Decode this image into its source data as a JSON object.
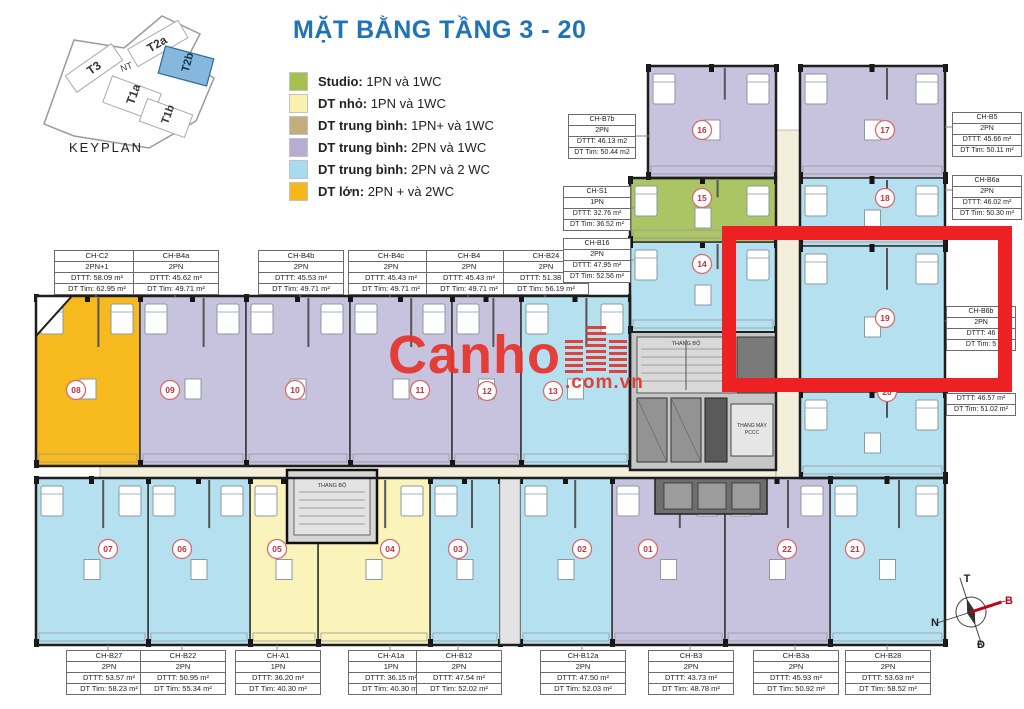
{
  "title": "MẶT BẰNG TẦNG 3 - 20",
  "keyplan": {
    "caption": "KEYPLAN",
    "buildings": [
      {
        "name": "T3"
      },
      {
        "name": "NT"
      },
      {
        "name": "T2a"
      },
      {
        "name": "T2b",
        "highlighted": true
      },
      {
        "name": "T1a"
      },
      {
        "name": "T1b"
      }
    ]
  },
  "legend": [
    {
      "color": "#a4c04e",
      "bold": "Studio:",
      "rest": " 1PN và 1WC"
    },
    {
      "color": "#f8f2ad",
      "bold": "DT nhỏ:",
      "rest": " 1PN  và 1WC"
    },
    {
      "color": "#c4ad7c",
      "bold": "DT trung bình:",
      "rest": " 1PN+ và 1WC"
    },
    {
      "color": "#b6add5",
      "bold": "DT trung bình:",
      "rest": " 2PN và 1WC"
    },
    {
      "color": "#a8dbed",
      "bold": "DT trung bình:",
      "rest": " 2PN và 2 WC"
    },
    {
      "color": "#f6b71b",
      "bold": "DT lớn:",
      "rest": " 2PN + và 2WC"
    }
  ],
  "watermark": {
    "word": "Canho",
    "suffix": ".com.vn"
  },
  "compass": {
    "top": "T",
    "right": "B",
    "left": "N",
    "bottom": "Đ"
  },
  "core_labels": {
    "stair1": "THANG BỘ",
    "stair2": "THANG BỘ",
    "fire1": "THANG MÁY",
    "fire2": "PCCC"
  },
  "colors": {
    "title_blue": "#2173b4",
    "annotation_red": "#ed2024",
    "watermark_red": "#e63329",
    "number_red": "#c23340",
    "corridor": "#f3eeda",
    "core_gray": "#c6c6c6",
    "unit_fills": {
      "green": "#abc464",
      "yellow": "#faf4bb",
      "lav": "#c7c2de",
      "blue": "#b4e0ef",
      "orange": "#f7ba1e"
    }
  },
  "units": [
    {
      "no": "01",
      "fill": "lav"
    },
    {
      "no": "02",
      "fill": "blue"
    },
    {
      "no": "03",
      "fill": "blue"
    },
    {
      "no": "04",
      "fill": "yellow"
    },
    {
      "no": "05",
      "fill": "yellow"
    },
    {
      "no": "06",
      "fill": "blue"
    },
    {
      "no": "07",
      "fill": "blue"
    },
    {
      "no": "08",
      "fill": "orange"
    },
    {
      "no": "09",
      "fill": "lav"
    },
    {
      "no": "10",
      "fill": "lav"
    },
    {
      "no": "11",
      "fill": "lav"
    },
    {
      "no": "12",
      "fill": "lav"
    },
    {
      "no": "13",
      "fill": "blue"
    },
    {
      "no": "14",
      "fill": "blue"
    },
    {
      "no": "15",
      "fill": "green"
    },
    {
      "no": "16",
      "fill": "lav"
    },
    {
      "no": "17",
      "fill": "lav"
    },
    {
      "no": "18",
      "fill": "blue"
    },
    {
      "no": "19",
      "fill": "blue"
    },
    {
      "no": "20",
      "fill": "blue"
    },
    {
      "no": "21",
      "fill": "blue"
    },
    {
      "no": "22",
      "fill": "lav"
    }
  ],
  "unit_labels": [
    {
      "name": "CH-C2",
      "type": "2PN+1",
      "dtt": "DTTT: 58.09 m²",
      "dttim": "DT Tim: 62.95 m²"
    },
    {
      "name": "CH-B4a",
      "type": "2PN",
      "dtt": "DTTT: 45.62 m²",
      "dttim": "DT Tim: 49.71 m²"
    },
    {
      "name": "CH-B4b",
      "type": "2PN",
      "dtt": "DTTT: 45.53 m²",
      "dttim": "DT Tim: 49.71 m²"
    },
    {
      "name": "CH-B4c",
      "type": "2PN",
      "dtt": "DTTT: 45.43 m²",
      "dttim": "DT Tim: 49.71 m²"
    },
    {
      "name": "CH-B4",
      "type": "2PN",
      "dtt": "DTTT: 45.43 m²",
      "dttim": "DT Tim: 49.71 m²"
    },
    {
      "name": "CH-B24",
      "type": "2PN",
      "dtt": "DTTT: 51.38 m²",
      "dttim": "DT Tim: 56.19 m²"
    },
    {
      "name": "CH-B7b",
      "type": "2PN",
      "dtt": "DTTT: 46.13 m2",
      "dttim": "DT Tim: 50.44 m2"
    },
    {
      "name": "CH-S1",
      "type": "1PN",
      "dtt": "DTTT: 32.76 m²",
      "dttim": "DT Tim: 36.52 m²"
    },
    {
      "name": "CH-B16",
      "type": "2PN",
      "dtt": "DTTT: 47.95 m²",
      "dttim": "DT Tim: 52.56 m²"
    },
    {
      "name": "CH-B5",
      "type": "2PN",
      "dtt": "DTTT: 45.66 m²",
      "dttim": "DT Tim: 50.11 m²"
    },
    {
      "name": "CH-B6a",
      "type": "2PN",
      "dtt": "DTTT: 46.02 m²",
      "dttim": "DT Tim: 50.30 m²"
    },
    {
      "name": "CH-B6b",
      "type": "2PN",
      "dtt": "DTTT: 46",
      "dttim": "DT Tim: 5"
    },
    {
      "name": "",
      "type": "",
      "dtt": "DTTT: 46.57 m²",
      "dttim": "DT Tim: 51.02 m²"
    },
    {
      "name": "CH-B27",
      "type": "2PN",
      "dtt": "DTTT: 53.57 m²",
      "dttim": "DT Tim: 58.23 m²"
    },
    {
      "name": "CH-B22",
      "type": "2PN",
      "dtt": "DTTT: 50.95 m²",
      "dttim": "DT Tim: 55.34 m²"
    },
    {
      "name": "CH-A1",
      "type": "1PN",
      "dtt": "DTTT: 36.20 m²",
      "dttim": "DT Tim: 40.30 m²"
    },
    {
      "name": "CH-A1a",
      "type": "1PN",
      "dtt": "DTTT: 36.15 m²",
      "dttim": "DT Tim: 40.30 m²"
    },
    {
      "name": "CH-B12",
      "type": "2PN",
      "dtt": "DTTT: 47.54 m²",
      "dttim": "DT Tim: 52.02 m²"
    },
    {
      "name": "CH-B12a",
      "type": "2PN",
      "dtt": "DTTT: 47.50 m²",
      "dttim": "DT Tim: 52.03 m²"
    },
    {
      "name": "CH-B3",
      "type": "2PN",
      "dtt": "DTTT: 43.73 m²",
      "dttim": "DT Tim: 48.78 m²"
    },
    {
      "name": "CH-B3a",
      "type": "2PN",
      "dtt": "DTTT: 45.93 m²",
      "dttim": "DT Tim: 50.92 m²"
    },
    {
      "name": "CH-B28",
      "type": "2PN",
      "dtt": "DTTT: 53.63 m²",
      "dttim": "DT Tim: 58.52 m²"
    }
  ]
}
